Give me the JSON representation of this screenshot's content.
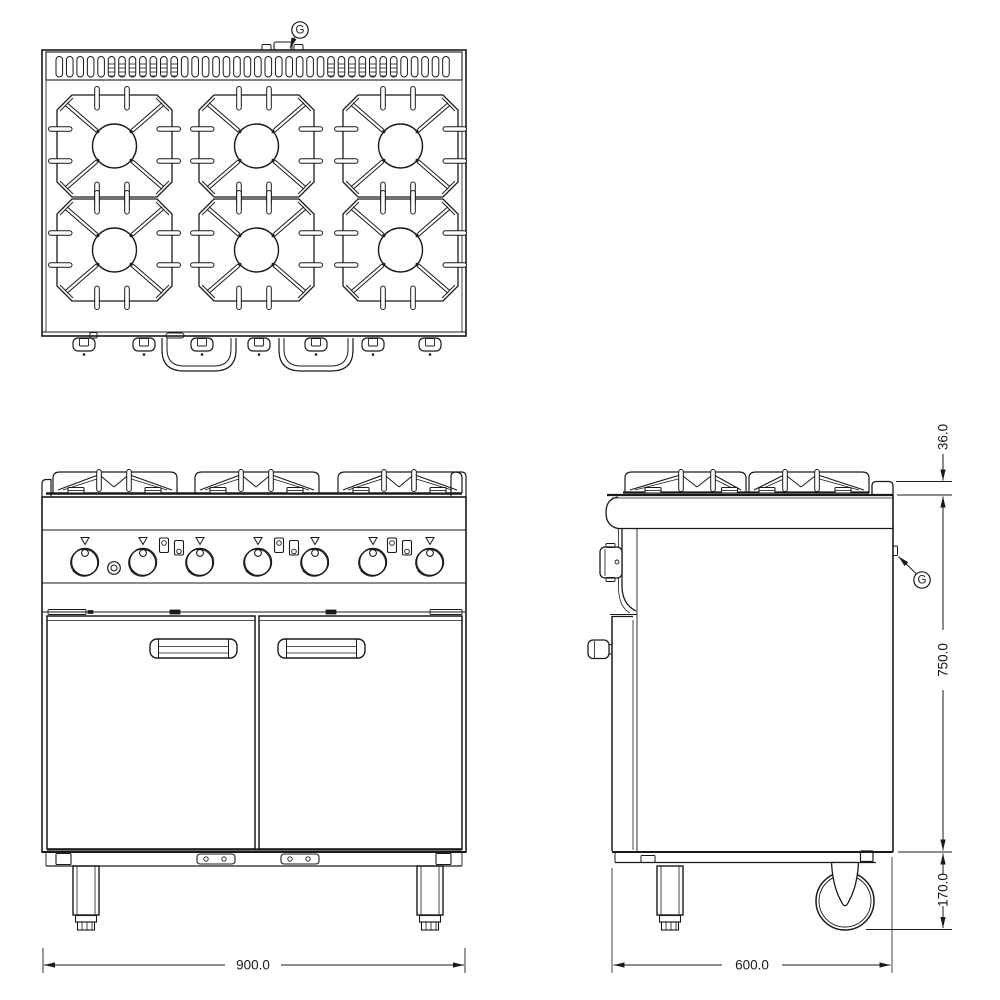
{
  "drawing": {
    "callouts": {
      "gas_top": "G",
      "gas_side": "G"
    },
    "dimensions": {
      "overall_width": "900.0",
      "overall_depth": "600.0",
      "body_height": "750.0",
      "base_height": "170.0",
      "rear_upstand_height": "36.0"
    }
  }
}
